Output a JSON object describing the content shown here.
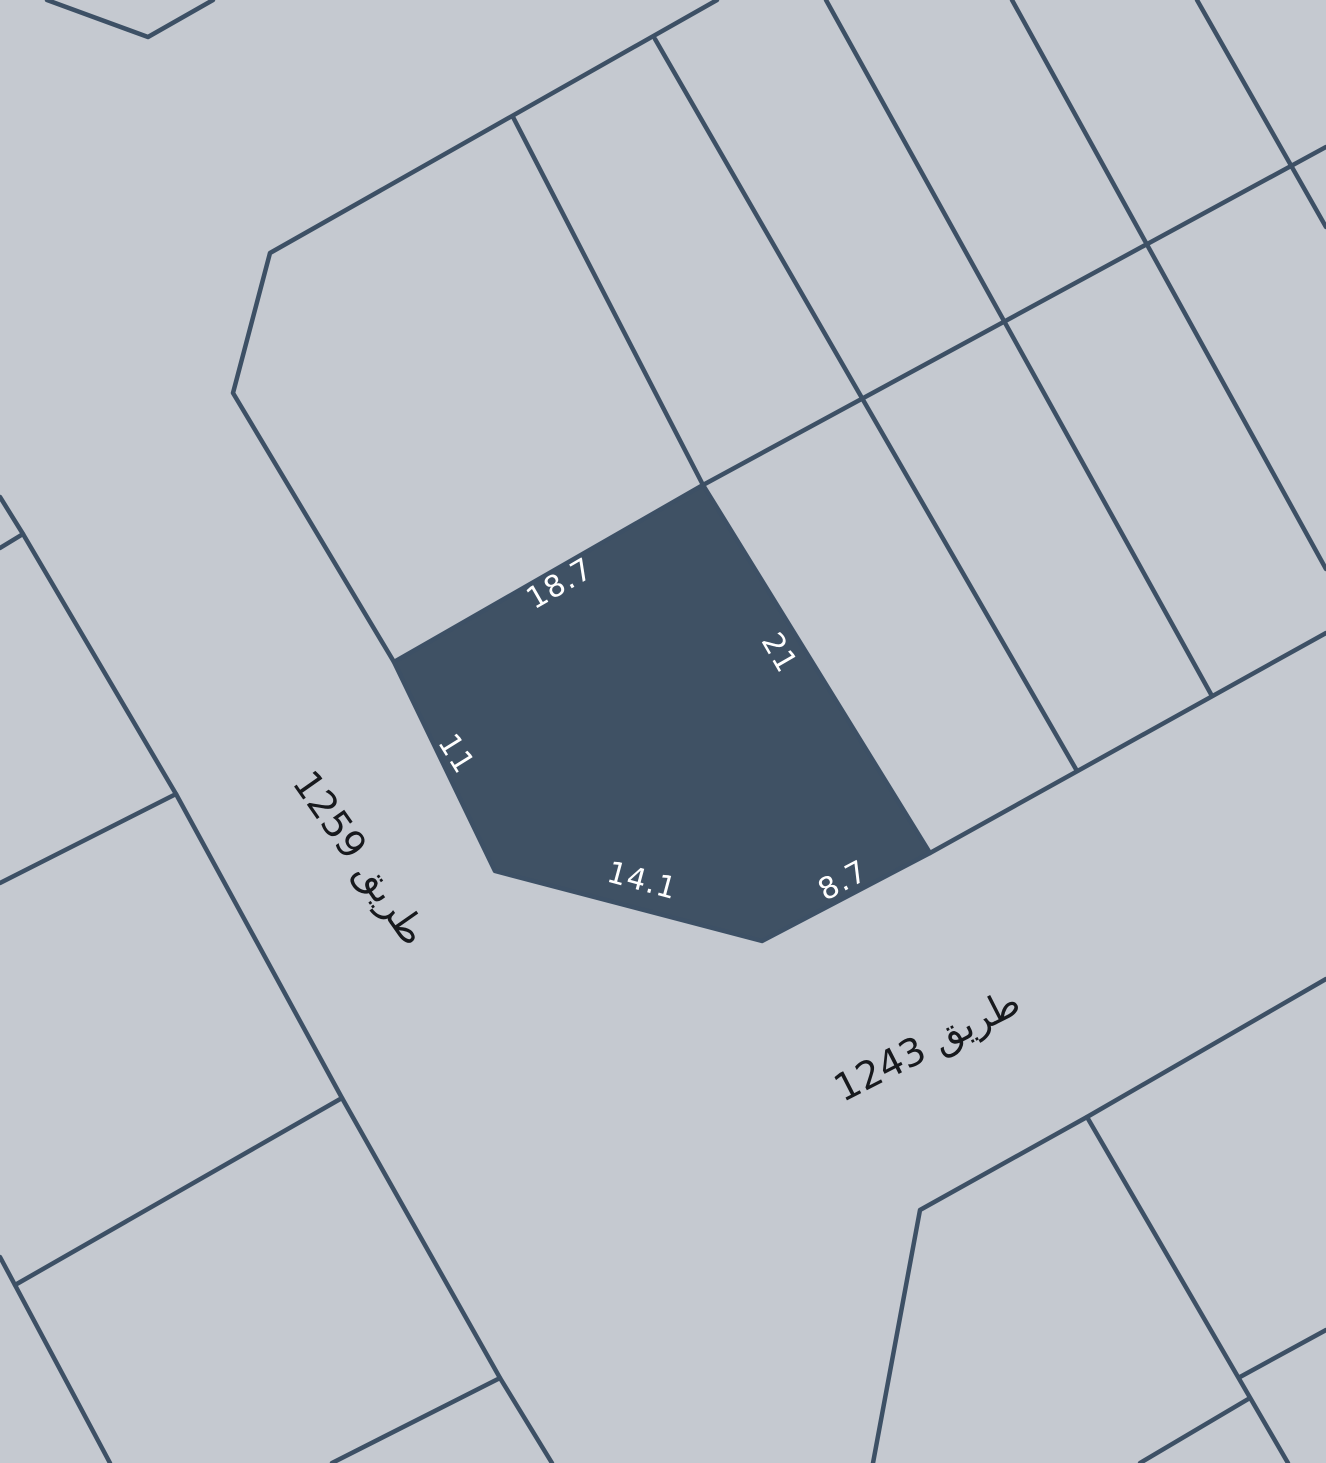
{
  "map": {
    "background_color": "#c5c9d0",
    "line_color": "#3d5065",
    "parcel_fill_color": "#3f5164",
    "dimension_label_color": "#ffffff",
    "street_label_color": "#17191d",
    "viewbox": "0 0 1326 1463"
  },
  "highlighted_parcel": {
    "points_attr": "703,485 930,853 762,941 495,871 394,662",
    "dimensions": [
      {
        "value": "18.7",
        "transform": "translate(560 584) rotate(-30)"
      },
      {
        "value": "21",
        "transform": "translate(779 653) rotate(60)"
      },
      {
        "value": "11",
        "transform": "translate(456 754) rotate(58)"
      },
      {
        "value": "14.1",
        "transform": "translate(642 881) rotate(15)"
      },
      {
        "value": "8.7",
        "transform": "translate(843 881) rotate(-28)"
      }
    ]
  },
  "streets": [
    {
      "name": "طريق 1259",
      "transform": "translate(360 858) rotate(55)"
    },
    {
      "name": "طريق 1243",
      "transform": "translate(927 1045) rotate(-27)"
    }
  ],
  "boundaries": [
    {
      "id": "top-left-corner-v",
      "points": "47,0 148,37 213,0"
    },
    {
      "id": "upper-block-west-edge",
      "points": "717,0 270,253 233,393 394,662"
    },
    {
      "id": "upper-nw-divider",
      "points": "513,117 703,485"
    },
    {
      "id": "upper-boundary-east",
      "points": "703,485 1326,147"
    },
    {
      "id": "divider-1",
      "points": "655,39 1077,771"
    },
    {
      "id": "divider-2",
      "points": "826,0 1212,696"
    },
    {
      "id": "divider-3",
      "points": "1012,0 1326,569"
    },
    {
      "id": "divider-4",
      "points": "1197,0 1326,227"
    },
    {
      "id": "road-1243-north-edge",
      "points": "930,853 1326,633"
    },
    {
      "id": "road-1243-south-edge",
      "points": "1326,979 1087,1117 920,1210 873,1463"
    },
    {
      "id": "se-block-divider",
      "points": "1087,1117 1288,1463"
    },
    {
      "id": "se-branch-northeast",
      "points": "1240,1377 1326,1330"
    },
    {
      "id": "se-branch-southwest",
      "points": "1250,1398 1140,1463"
    },
    {
      "id": "road-1259-west-edge",
      "points": "0,497 23,534 176,794 342,1098 500,1378 552,1463"
    },
    {
      "id": "west-corner-divider",
      "points": "23,534 0,548"
    },
    {
      "id": "west-divider-1",
      "points": "176,794 0,883"
    },
    {
      "id": "west-divider-2",
      "points": "342,1098 15,1285"
    },
    {
      "id": "far-west-block-edge",
      "points": "0,1257 15,1285 110,1463"
    },
    {
      "id": "west-divider-3",
      "points": "500,1378 332,1463"
    }
  ]
}
